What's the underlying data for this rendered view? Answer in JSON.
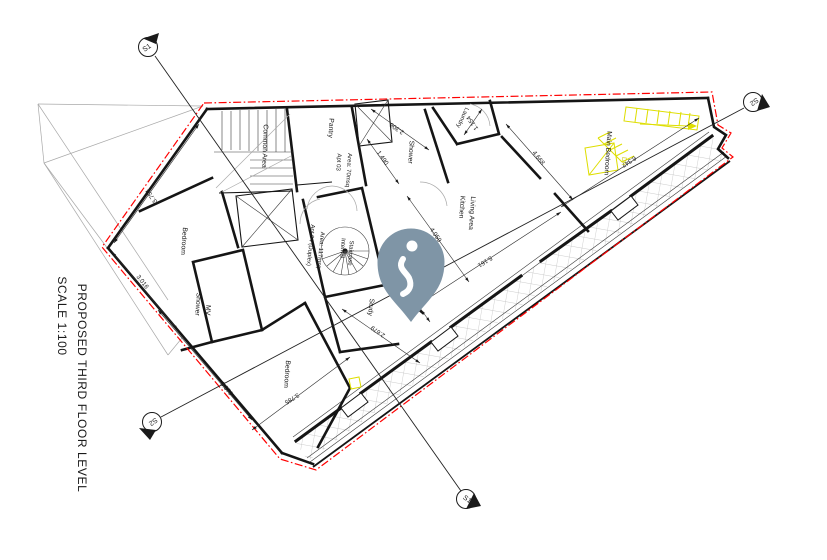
{
  "drawing": {
    "title": "PROPOSED THIRD FLOOR LEVEL",
    "scale": "SCALE 1:100"
  },
  "section_markers": {
    "s1": "S1",
    "s2": "S2"
  },
  "rooms": {
    "common_area": "Common Area",
    "pantry": "Pantry",
    "apt03_name": "Apt 03",
    "apt03_area": "Area: 70msq",
    "shower": "Shower",
    "laundry": "Laundry",
    "kitchen_line1": "Kitchen",
    "kitchen_line2": "Living Area",
    "main_bedroom": "Main Bedroom",
    "bedroom_left": "Bedroom",
    "shower_mv_line1": "Shower",
    "shower_mv_line2": "MV",
    "bedroom_bottom": "Bedroom",
    "study": "Study",
    "internal_stair_line1": "Internal",
    "internal_stair_line2": "Staircase",
    "apt04_name": "Apt 04 (Duplex)",
    "apt04_area": "Area: 117msq",
    "stair_down": "Dn"
  },
  "dimensions": {
    "left_upper": "3.754",
    "left_lower": "3.016",
    "bedroom2_side": "3.579",
    "bedroom2_terrace": "3.785",
    "corridor": "2.679",
    "study_wall": "2.513",
    "kitchen_width": "4.059",
    "kitchen_length": "5.161",
    "mainbed_width": "4.668",
    "mainbed_length": "6.347",
    "shower_width": "2.306",
    "shower_depth": "1.490",
    "laundry_width": "1.154"
  },
  "pin": {
    "color": "#7f95a6"
  },
  "colors": {
    "boundary": "#ff0000",
    "stairs_highlight": "#dede00",
    "walls": "#151515",
    "hatch": "#bcbcbc"
  }
}
